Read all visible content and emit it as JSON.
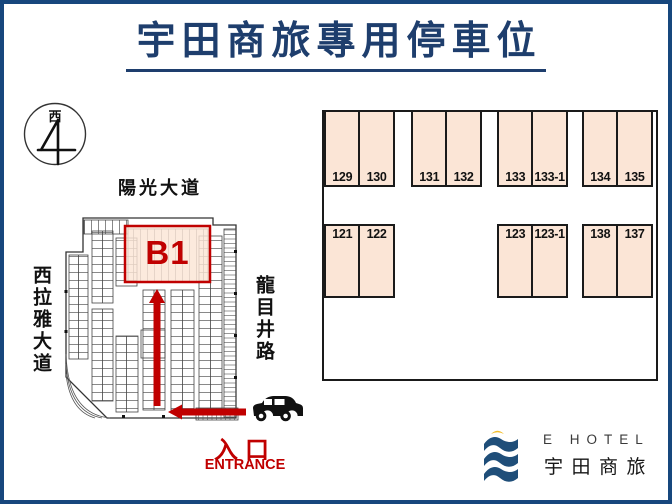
{
  "title": {
    "text": "宇田商旅專用停車位"
  },
  "compass": {
    "direction": "西"
  },
  "map": {
    "street_top": "陽光大道",
    "street_left": "西拉雅大道",
    "street_right": "龍目井路",
    "zone": "B1",
    "entrance_zh": "入口",
    "entrance_en": "ENTRANCE"
  },
  "lot": {
    "top_row": [
      [
        "129",
        "130"
      ],
      [
        "131",
        "132"
      ],
      [
        "133",
        "133-1"
      ],
      [
        "134",
        "135"
      ]
    ],
    "bottom_row": [
      [
        "121",
        "122"
      ],
      [
        "123",
        "123-1"
      ],
      [
        "138",
        "137"
      ]
    ]
  },
  "logo": {
    "en": "E HOTEL",
    "zh": "宇田商旅"
  },
  "colors": {
    "frame_navy": "#17477d",
    "title_navy": "#1e3e6d",
    "accent_red": "#c00000",
    "stall_fill": "#fbe5d6",
    "logo_blue": "#1f4e79",
    "logo_gold": "#f2bd2a"
  }
}
